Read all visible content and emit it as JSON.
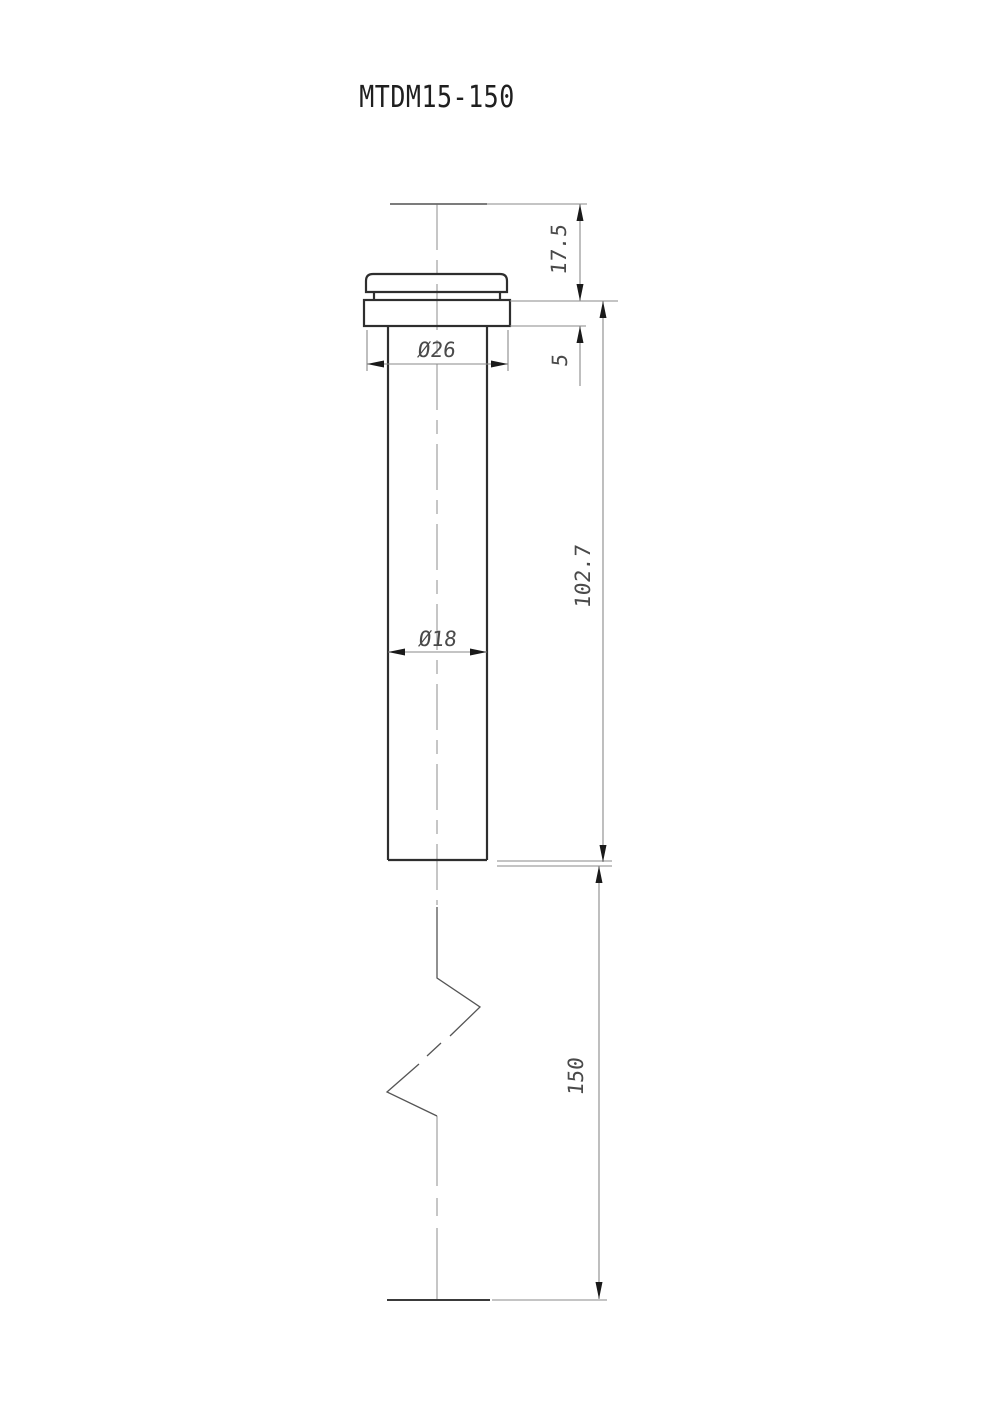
{
  "page": {
    "title": "MTDM15-150"
  },
  "drawing": {
    "part_number": "MTDM15-150",
    "view": "front-section-with-break",
    "dimensions": {
      "cap_height": "17.5",
      "flange_thickness": "5",
      "flange_diameter": "Ø26",
      "body_diameter": "Ø18",
      "body_length": "102.7",
      "overall_length": "150"
    },
    "colors": {
      "outline": "#2e2e2e",
      "dimension_lines": "#8a8a8a",
      "center_line": "#979797",
      "arrows": "#1a1a1a",
      "text": "#4a4a4a",
      "background": "#ffffff"
    }
  }
}
